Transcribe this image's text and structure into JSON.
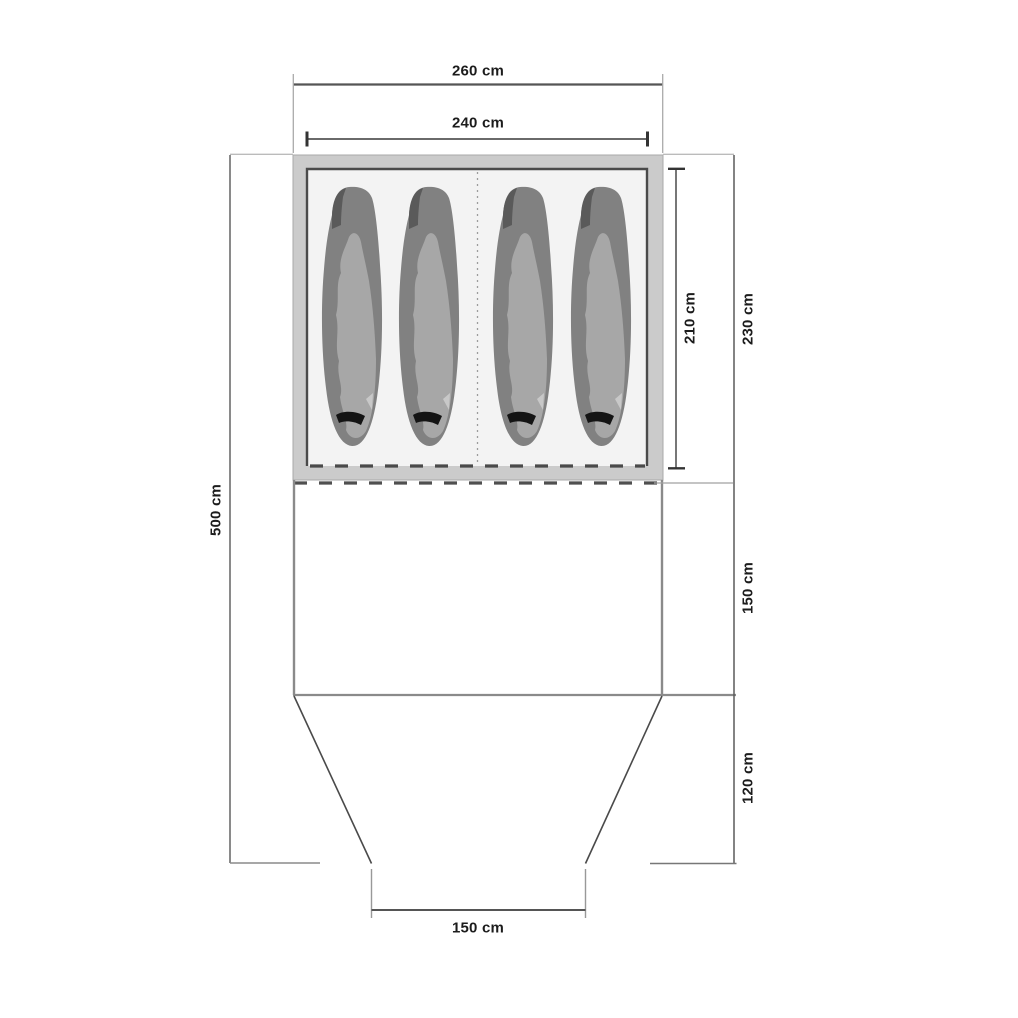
{
  "diagram": {
    "type": "tent-floorplan-top-view",
    "units": "cm",
    "labels": {
      "outer_width": "260 cm",
      "inner_width": "240 cm",
      "inner_depth": "210 cm",
      "sleeping_depth": "230 cm",
      "total_depth": "500 cm",
      "living_depth": "150 cm",
      "porch_depth": "120 cm",
      "entrance_width": "150 cm"
    },
    "sleeping_bag_count": 4,
    "sections": [
      "sleeping cabin",
      "living area",
      "porch"
    ],
    "colors": {
      "background": "#ffffff",
      "canopy_band": "#cbcbcb",
      "inner_floor": "#f3f3f3",
      "inner_border": "#4a4a4a",
      "bag_body": "#818181",
      "bag_hood_notch": "#5a5a5a",
      "bag_top_surface": "#a7a7a7",
      "bag_highlight": "#c8c8c8",
      "bag_zipper_mark": "#141414",
      "wall_line": "#8a8a8a",
      "dimension_line": "#555555",
      "extension_line": "#aaaaaa",
      "text": "#1c1c1c"
    }
  }
}
